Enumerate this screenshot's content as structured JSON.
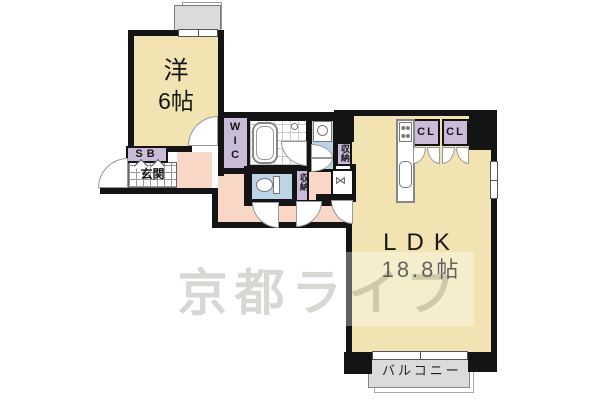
{
  "watermark": {
    "text": "京都ライフ"
  },
  "rooms": {
    "western": {
      "name": "洋",
      "area": "6帖"
    },
    "ldk": {
      "name": "LDK",
      "area": "18.8帖"
    },
    "balcony": {
      "label": "バルコニー"
    },
    "entrance": {
      "label": "玄関"
    },
    "shoe_box": {
      "label": "SB"
    },
    "walk_in_closet": {
      "label": "WIC"
    },
    "storage_upper": {
      "label": "収納"
    },
    "storage_lower": {
      "label": "収納"
    },
    "closet_left": {
      "label": "CL"
    },
    "closet_right": {
      "label": "CL"
    }
  },
  "colors": {
    "wall": "#141414",
    "room-beige": "#F1E4B2",
    "closet-lavender": "#CBBBD9",
    "wet-blue": "#BCD4E6",
    "hall-pink": "#F8D7C6",
    "balcony-gray": "#DBDBDB"
  }
}
